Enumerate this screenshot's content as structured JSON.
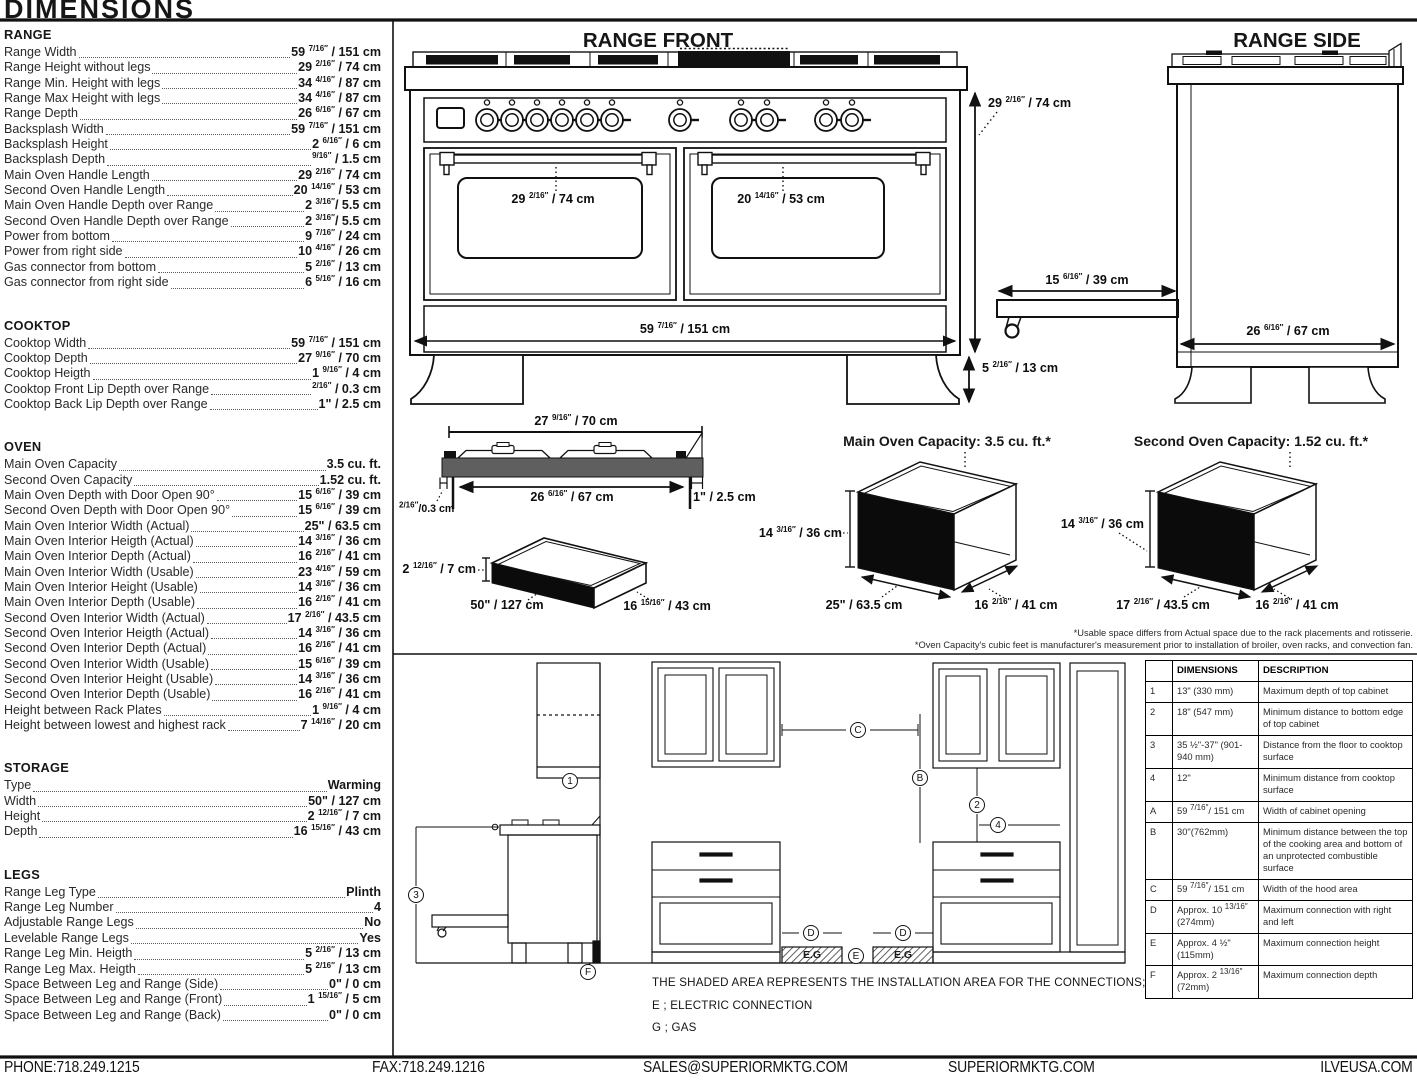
{
  "header": {
    "title": "DIMENSIONS"
  },
  "specs": [
    {
      "name": "RANGE",
      "rows": [
        {
          "l": "Range Width",
          "v": "59 7/16\" / 151 cm"
        },
        {
          "l": "Range Height without legs",
          "v": "29 2/16\" / 74 cm"
        },
        {
          "l": "Range Min. Height with legs",
          "v": "34 4/16\" / 87 cm"
        },
        {
          "l": "Range Max Height with legs",
          "v": "34 4/16\" / 87 cm"
        },
        {
          "l": "Range Depth",
          "v": "26 6/16\" / 67 cm"
        },
        {
          "l": "Backsplash Width",
          "v": "59 7/16\" / 151 cm"
        },
        {
          "l": "Backsplash Height",
          "v": "2 6/16\" / 6 cm"
        },
        {
          "l": "Backsplash Depth",
          "v": "9/16\" / 1.5 cm"
        },
        {
          "l": "Main Oven Handle Length",
          "v": "29 2/16\" / 74 cm"
        },
        {
          "l": "Second Oven Handle Length",
          "v": "20 14/16\" / 53 cm"
        },
        {
          "l": "Main Oven Handle Depth over Range",
          "v": "2 3/16\"/ 5.5 cm"
        },
        {
          "l": "Second Oven Handle Depth over Range",
          "v": "2 3/16\"/ 5.5 cm"
        },
        {
          "l": "Power from bottom",
          "v": "9 7/16\" / 24 cm"
        },
        {
          "l": "Power from right side",
          "v": "10 4/16\" / 26 cm"
        },
        {
          "l": "Gas connector from bottom",
          "v": "5 2/16\" / 13 cm"
        },
        {
          "l": "Gas connector from right side",
          "v": "6 5/16\" / 16 cm"
        }
      ]
    },
    {
      "name": "COOKTOP",
      "rows": [
        {
          "l": "Cooktop Width",
          "v": "59 7/16\" / 151 cm"
        },
        {
          "l": "Cooktop Depth",
          "v": "27 9/16\" / 70 cm"
        },
        {
          "l": "Cooktop Heigth",
          "v": "1 9/16\" / 4 cm"
        },
        {
          "l": "Cooktop Front Lip Depth over Range",
          "v": "2/16\" / 0.3 cm"
        },
        {
          "l": "Cooktop Back Lip Depth over Range",
          "v": "1\" / 2.5 cm"
        }
      ]
    },
    {
      "name": "OVEN",
      "rows": [
        {
          "l": "Main Oven Capacity",
          "v": "3.5 cu. ft."
        },
        {
          "l": "Second Oven Capacity",
          "v": "1.52 cu. ft."
        },
        {
          "l": "Main Oven Depth with Door Open 90°",
          "v": "15 6/16\" / 39 cm"
        },
        {
          "l": "Second Oven Depth with Door Open 90°",
          "v": "15 6/16\" / 39 cm"
        },
        {
          "l": "Main Oven Interior Width (Actual)",
          "v": "25\" / 63.5 cm"
        },
        {
          "l": "Main Oven Interior Heigth (Actual)",
          "v": "14 3/16\" / 36 cm"
        },
        {
          "l": "Main Oven Interior Depth (Actual)",
          "v": "16 2/16\" / 41 cm"
        },
        {
          "l": "Main Oven Interior Width (Usable)",
          "v": "23 4/16\" / 59 cm"
        },
        {
          "l": "Main Oven Interior Height (Usable)",
          "v": "14 3/16\" / 36 cm"
        },
        {
          "l": "Main Oven Interior Depth (Usable)",
          "v": "16 2/16\" / 41 cm"
        },
        {
          "l": "Second Oven Interior Width (Actual)",
          "v": "17 2/16\" / 43.5 cm"
        },
        {
          "l": "Second Oven Interior Heigth (Actual)",
          "v": "14 3/16\" / 36 cm"
        },
        {
          "l": "Second Oven Interior Depth (Actual)",
          "v": "16 2/16\" / 41 cm"
        },
        {
          "l": "Second Oven Interior Width (Usable)",
          "v": "15 6/16\" / 39 cm"
        },
        {
          "l": "Second Oven Interior Height (Usable)",
          "v": "14 3/16\" / 36 cm"
        },
        {
          "l": "Second Oven Interior Depth (Usable)",
          "v": "16 2/16\" / 41 cm"
        },
        {
          "l": "Height between Rack Plates",
          "v": "1 9/16\" / 4 cm"
        },
        {
          "l": "Height between lowest and highest rack",
          "v": "7 14/16\" / 20 cm"
        }
      ]
    },
    {
      "name": "STORAGE",
      "rows": [
        {
          "l": "Type",
          "v": "Warming"
        },
        {
          "l": "Width",
          "v": "50\" / 127 cm"
        },
        {
          "l": "Height",
          "v": "2 12/16\" / 7 cm"
        },
        {
          "l": "Depth",
          "v": "16 15/16\" / 43 cm"
        }
      ]
    },
    {
      "name": "LEGS",
      "rows": [
        {
          "l": "Range Leg Type",
          "v": "Plinth"
        },
        {
          "l": "Range Leg Number",
          "v": "4"
        },
        {
          "l": "Adjustable Range Legs",
          "v": "No"
        },
        {
          "l": "Levelable Range Legs",
          "v": "Yes"
        },
        {
          "l": "Range Leg Min. Heigth",
          "v": "5 2/16\" / 13 cm"
        },
        {
          "l": "Range Leg Max. Heigth",
          "v": "5 2/16\" / 13 cm"
        },
        {
          "l": "Space Between Leg and Range (Side)",
          "v": "0\" / 0 cm"
        },
        {
          "l": "Space Between Leg and Range (Front)",
          "v": "1 15/16\" / 5 cm"
        },
        {
          "l": "Space Between Leg and Range (Back)",
          "v": "0\" / 0 cm"
        }
      ]
    }
  ],
  "front": {
    "title": "RANGE FRONT",
    "height": "29 2/16\" / 74 cm",
    "main_handle": "29 2/16\" / 74 cm",
    "second_handle": "20 14/16\" / 53 cm",
    "width": "59 7/16\" / 151 cm",
    "leg": "5 2/16\" / 13 cm",
    "shelf_depth": "15 6/16\" / 39 cm"
  },
  "side": {
    "title": "RANGE SIDE",
    "depth": "26 6/16\" / 67 cm"
  },
  "cooktop_view": {
    "top_width": "27 9/16\" / 70 cm",
    "inner_width": "26 6/16\" / 67 cm",
    "back_lip": "1\" / 2.5 cm",
    "front_lip": "2/16\"/0.3 cm"
  },
  "storage_view": {
    "height": "2 12/16\" / 7 cm",
    "width": "50\" / 127 cm",
    "depth": "16 15/16\" / 43 cm"
  },
  "ovens": {
    "main": {
      "title": "Main Oven Capacity: 3.5 cu. ft.*",
      "h": "14 3/16\" / 36 cm",
      "w": "25\" / 63.5 cm",
      "d": "16 2/16\" / 41 cm"
    },
    "second": {
      "title": "Second Oven Capacity: 1.52 cu. ft.*",
      "h": "14 3/16\" / 36 cm",
      "w": "17 2/16\" / 43.5 cm",
      "d": "16 2/16\" / 41 cm"
    }
  },
  "notes": [
    "*Usable space differs from Actual space due to the rack placements and rotisserie.",
    "*Oven Capacity's cubic feet is manufacturer's measurement prior to installation of broiler, oven racks, and convection fan."
  ],
  "install": {
    "markers": [
      {
        "t": "1",
        "x": 570,
        "y": 781
      },
      {
        "t": "3",
        "x": 416,
        "y": 895
      },
      {
        "t": "F",
        "x": 588,
        "y": 972
      },
      {
        "t": "C",
        "x": 858,
        "y": 730
      },
      {
        "t": "B",
        "x": 920,
        "y": 778
      },
      {
        "t": "2",
        "x": 977,
        "y": 805
      },
      {
        "t": "4",
        "x": 998,
        "y": 825
      },
      {
        "t": "D",
        "x": 811,
        "y": 933
      },
      {
        "t": "D",
        "x": 903,
        "y": 933
      },
      {
        "t": "E",
        "x": 856,
        "y": 956
      }
    ],
    "hatch_label": "E.G",
    "shaded_text": "THE SHADED AREA REPRESENTS THE INSTALLATION AREA FOR THE CONNECTIONS;",
    "legend": [
      "E ; ELECTRIC CONNECTION",
      "G ; GAS"
    ]
  },
  "table": {
    "col_dim": "DIMENSIONS",
    "col_desc": "DESCRIPTION",
    "rows": [
      {
        "id": "1",
        "dim": "13\" (330 mm)",
        "desc": "Maximum depth of top cabinet"
      },
      {
        "id": "2",
        "dim": "18\" (547 mm)",
        "desc": "Minimum distance to bottom edge of top cabinet"
      },
      {
        "id": "3",
        "dim": "35 ½\"-37\" (901-940 mm)",
        "desc": "Distance from the floor to cooktop surface"
      },
      {
        "id": "4",
        "dim": "12\"",
        "desc": "Minimum distance from cooktop surface"
      },
      {
        "id": "A",
        "dim": "59 7/16\"/ 151 cm",
        "desc": "Width of cabinet opening"
      },
      {
        "id": "B",
        "dim": "30\"(762mm)",
        "desc": "Minimum distance between the top of the cooking area and bottom of an unprotected combustible surface"
      },
      {
        "id": "C",
        "dim": "59 7/16\"/ 151 cm",
        "desc": "Width of the hood area"
      },
      {
        "id": "D",
        "dim": "Approx. 10 13/16\" (274mm)",
        "desc": "Maximum connection with right and left"
      },
      {
        "id": "E",
        "dim": "Approx. 4 ½\" (115mm)",
        "desc": "Maximum connection height"
      },
      {
        "id": "F",
        "dim": "Approx. 2 13/16\" (72mm)",
        "desc": "Maximum connection depth"
      }
    ]
  },
  "footer": {
    "phone": "PHONE:718.249.1215",
    "fax": "FAX:718.249.1216",
    "email": "SALES@SUPERIORMKTG.COM",
    "web1": "SUPERIORMKTG.COM",
    "web2": "ILVEUSA.COM"
  }
}
